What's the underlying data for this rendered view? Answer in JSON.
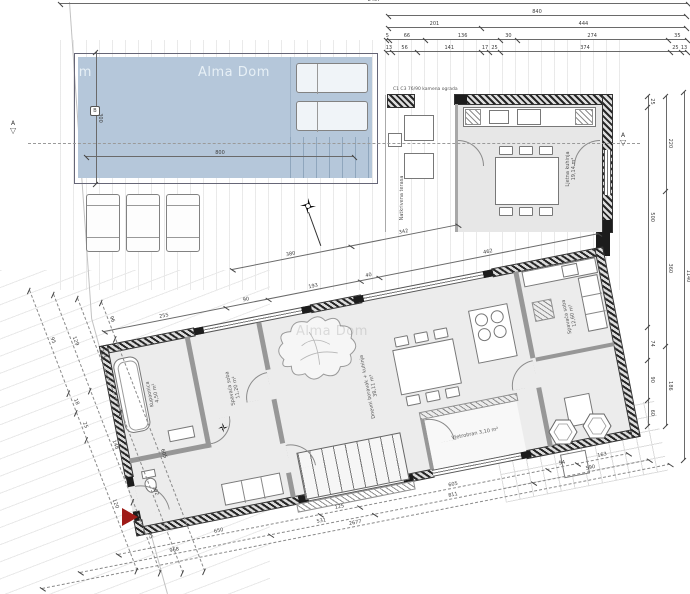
{
  "watermarks": {
    "main": "Alma Dom",
    "partial": "Alma Dom",
    "faint": "Alma Dom"
  },
  "section": {
    "label_left": "A",
    "label_right": "A",
    "triangle": "▽"
  },
  "pool": {
    "marker": "B"
  },
  "notes": {
    "fence": "C1 C3 76/90 kamena ograda"
  },
  "rooms": {
    "bathroom": {
      "name": "Kupaonica",
      "area": "4,50 m²"
    },
    "bedroom1": {
      "name": "Spavaća soba",
      "area": "11,20 m²"
    },
    "living": {
      "name": "Dnevni boravak + kuhinja",
      "area": "38,11 m²"
    },
    "bedroom2": {
      "name": "Spavaća soba",
      "area": "12,60 m²"
    },
    "summer_kitchen": {
      "name": "Ljetna kuhinja",
      "area": "19,14 m²"
    },
    "terrace": {
      "name": "Natkrivena terasa",
      "area": ""
    },
    "entry": {
      "name": "Vjetrobran",
      "area": "3,10 m²"
    }
  },
  "colors": {
    "pool": "#b5c7da",
    "red_marker": "#9e1b17",
    "wall_dark": "#262626"
  },
  "chains": [
    {
      "id": "top-full",
      "x": 60,
      "y": 3,
      "len": 628,
      "angle": 0,
      "values": [
        8407
      ]
    },
    {
      "id": "top-1",
      "x": 388,
      "y": 15,
      "len": 298,
      "angle": 0,
      "values": [
        840
      ]
    },
    {
      "id": "top-2",
      "x": 388,
      "y": 27,
      "len": 298,
      "angle": 0,
      "values": [
        201,
        444
      ]
    },
    {
      "id": "top-3",
      "x": 386,
      "y": 39,
      "len": 301,
      "angle": 0,
      "values": [
        5,
        66,
        136,
        30,
        274,
        35
      ]
    },
    {
      "id": "top-4",
      "x": 386,
      "y": 51,
      "len": 301,
      "angle": 0,
      "values": [
        13,
        56,
        141,
        17,
        25,
        374,
        25,
        13
      ]
    },
    {
      "id": "right-1",
      "x": 649,
      "y": 96,
      "len": 330,
      "angle": 90,
      "values": [
        25,
        500,
        74,
        90,
        60
      ]
    },
    {
      "id": "right-2",
      "x": 667,
      "y": 96,
      "len": 330,
      "angle": 90,
      "values": [
        220,
        360,
        186
      ]
    },
    {
      "id": "right-3",
      "x": 685,
      "y": 92,
      "len": 368,
      "angle": 90,
      "values": [
        1140
      ]
    },
    {
      "id": "pool-width",
      "x": 86,
      "y": 156,
      "len": 268,
      "angle": 0,
      "values": [
        800
      ]
    },
    {
      "id": "pool-side",
      "x": 97,
      "y": 52,
      "len": 132,
      "angle": 90,
      "values": [
        300
      ]
    },
    {
      "id": "house-top-1",
      "x": 104,
      "y": 331,
      "len": 504,
      "angle": -11.2,
      "values": [
        255,
        90,
        193,
        40,
        462
      ]
    },
    {
      "id": "house-top-2",
      "x": 232,
      "y": 269,
      "len": 230,
      "angle": -11.2,
      "values": [
        380,
        342
      ]
    },
    {
      "id": "bottom-1",
      "x": 118,
      "y": 554,
      "len": 520,
      "angle": -11.2,
      "values": [
        650,
        125,
        605,
        94,
        163
      ],
      "dashed": true
    },
    {
      "id": "bottom-2",
      "x": 80,
      "y": 572,
      "len": 580,
      "angle": -11.2,
      "values": [
        968,
        531,
        811,
        590
      ],
      "dashed": true
    },
    {
      "id": "bottom-3",
      "x": 42,
      "y": 588,
      "len": 640,
      "angle": -11.2,
      "values": [
        2677
      ],
      "dashed": true
    },
    {
      "id": "left-1",
      "x": 30,
      "y": 290,
      "len": 300,
      "angle": 69,
      "values": [
        95,
        18,
        25,
        120
      ],
      "dashed": true
    },
    {
      "id": "left-2",
      "x": 54,
      "y": 294,
      "len": 298,
      "angle": 69,
      "values": [
        129,
        148,
        95
      ],
      "dashed": true
    },
    {
      "id": "left-3",
      "x": 78,
      "y": 298,
      "len": 294,
      "angle": 69,
      "values": [
        213,
        302
      ],
      "dashed": true
    },
    {
      "id": "left-4",
      "x": 102,
      "y": 302,
      "len": 288,
      "angle": 69,
      "values": [
        96,
        605
      ],
      "dashed": true
    }
  ]
}
